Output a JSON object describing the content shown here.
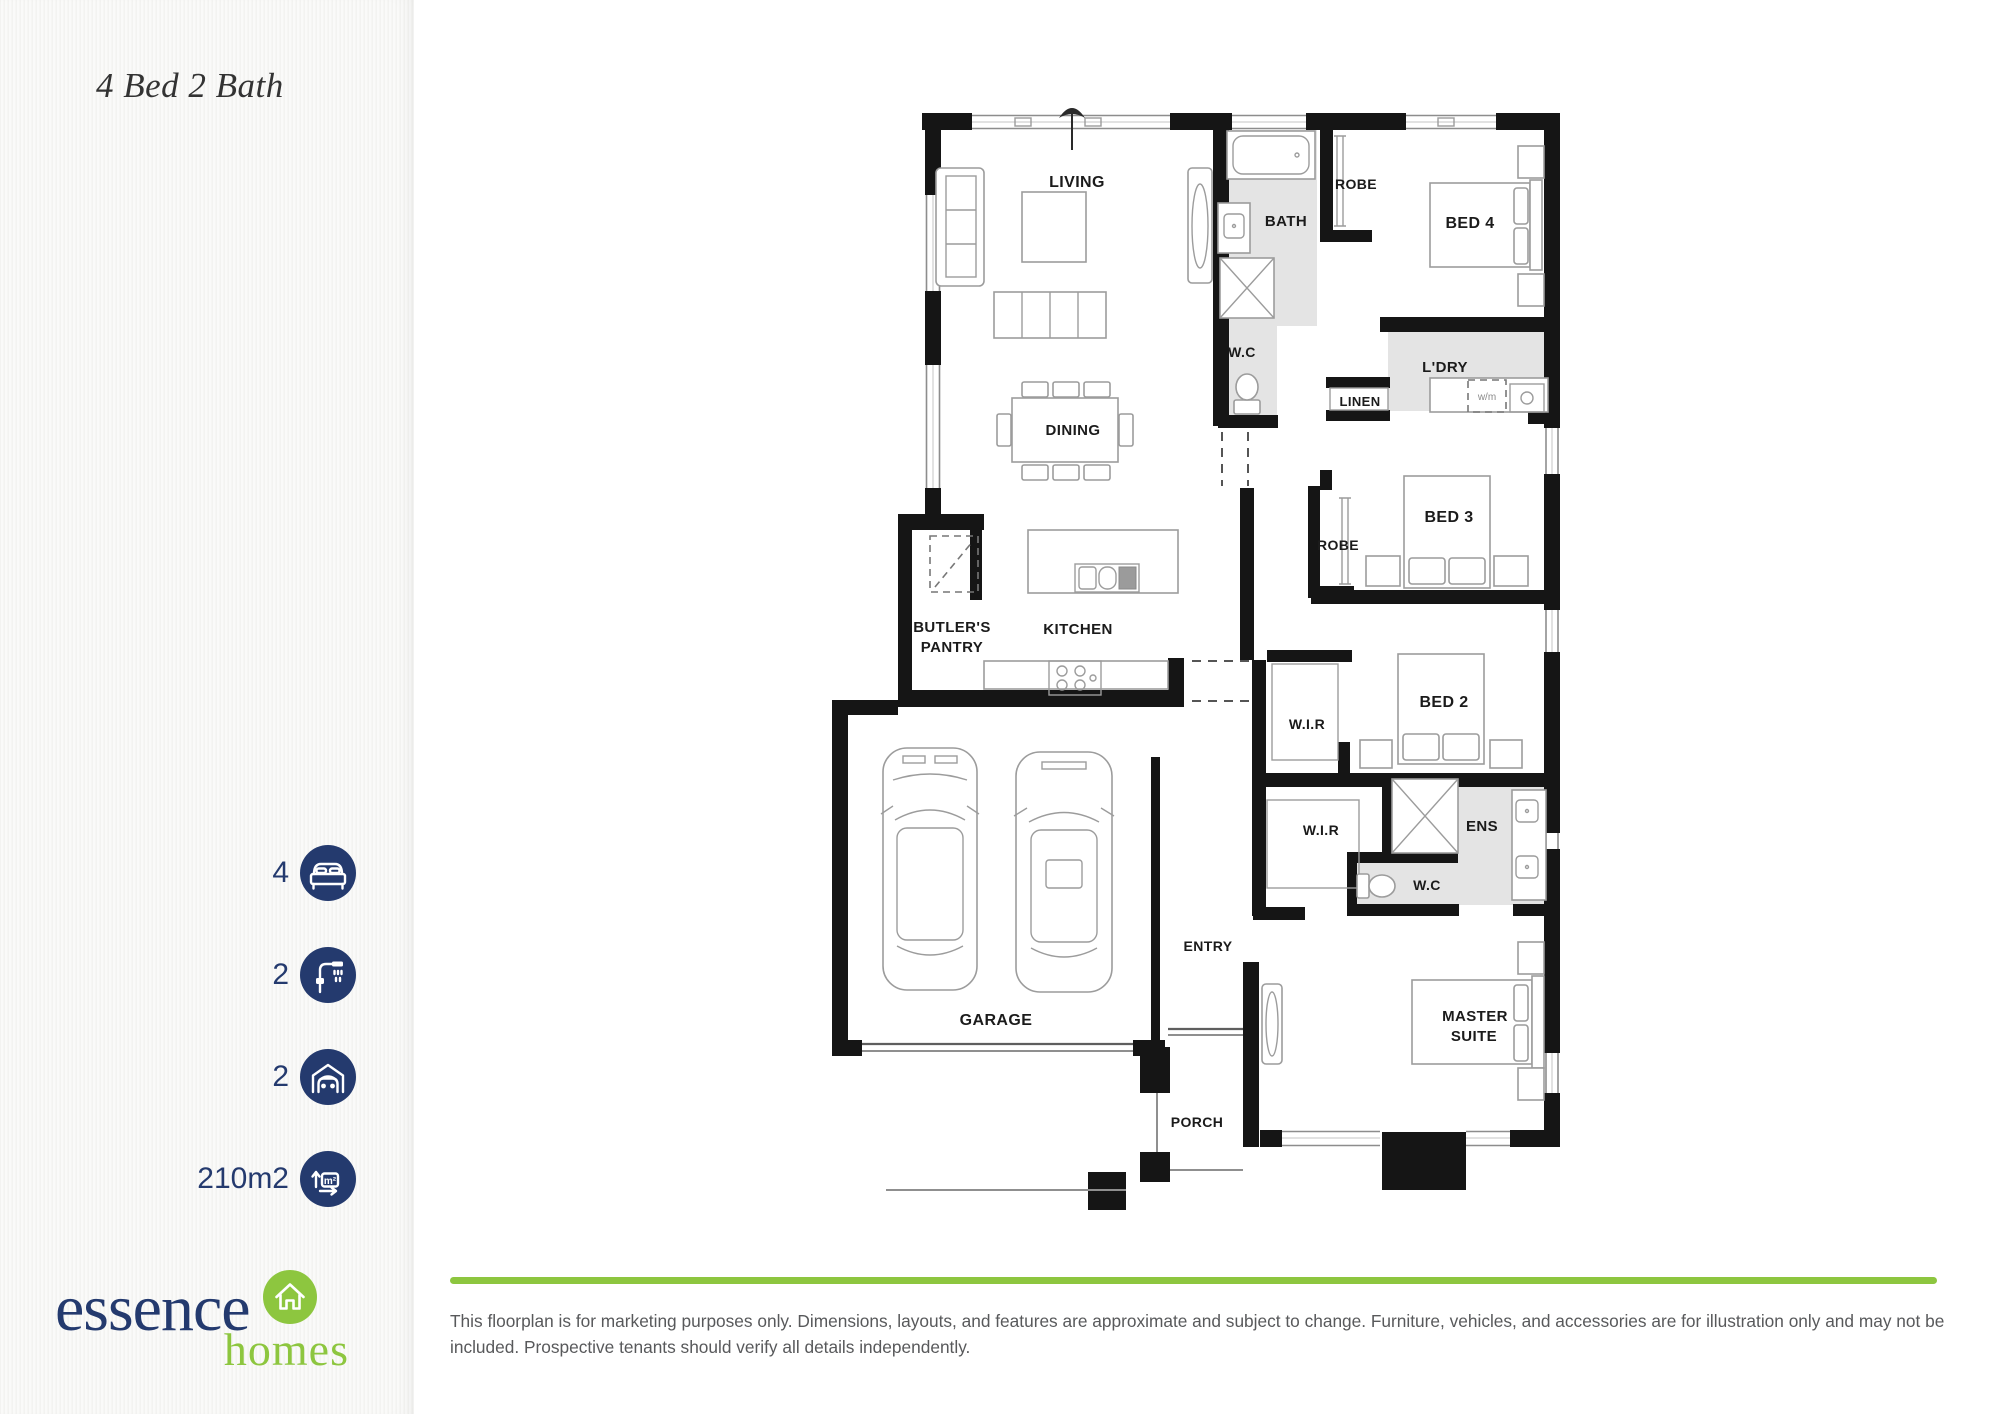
{
  "colors": {
    "navy": "#243a6e",
    "green": "#8dc63f",
    "wall": "#151515",
    "wet": "#e4e4e4",
    "ink": "#1b1b1b",
    "muted": "#58595b"
  },
  "sidebar": {
    "title": "4 Bed 2 Bath",
    "stats": [
      {
        "value": "4",
        "icon": "bed-icon"
      },
      {
        "value": "2",
        "icon": "shower-icon"
      },
      {
        "value": "2",
        "icon": "car-garage-icon"
      },
      {
        "value": "210m2",
        "icon": "floor-area-icon",
        "icon_label": "m²"
      }
    ],
    "logo": {
      "name": "essence",
      "sub": "homes",
      "icon": "house-icon"
    }
  },
  "floorplan": {
    "labels": [
      {
        "text": "LIVING"
      },
      {
        "text": "BATH"
      },
      {
        "text": "ROBE"
      },
      {
        "text": "BED 4"
      },
      {
        "text": "W.C"
      },
      {
        "text": "L'DRY"
      },
      {
        "text": "LINEN"
      },
      {
        "text": "DINING"
      },
      {
        "text": "BED 3"
      },
      {
        "text": "ROBE"
      },
      {
        "text": "BUTLER'S"
      },
      {
        "text": "PANTRY"
      },
      {
        "text": "KITCHEN"
      },
      {
        "text": "W.I.R"
      },
      {
        "text": "BED 2"
      },
      {
        "text": "W.I.R"
      },
      {
        "text": "ENS"
      },
      {
        "text": "W.C"
      },
      {
        "text": "ENTRY"
      },
      {
        "text": "GARAGE"
      },
      {
        "text": "MASTER"
      },
      {
        "text": "SUITE"
      },
      {
        "text": "PORCH"
      },
      {
        "text": "w/m"
      }
    ]
  },
  "footer": {
    "disclaimer": "This floorplan is for marketing purposes only. Dimensions, layouts, and features are approximate and subject to change. Furniture, vehicles, and accessories are for illustration only and may not be included. Prospective tenants should verify all details independently."
  }
}
